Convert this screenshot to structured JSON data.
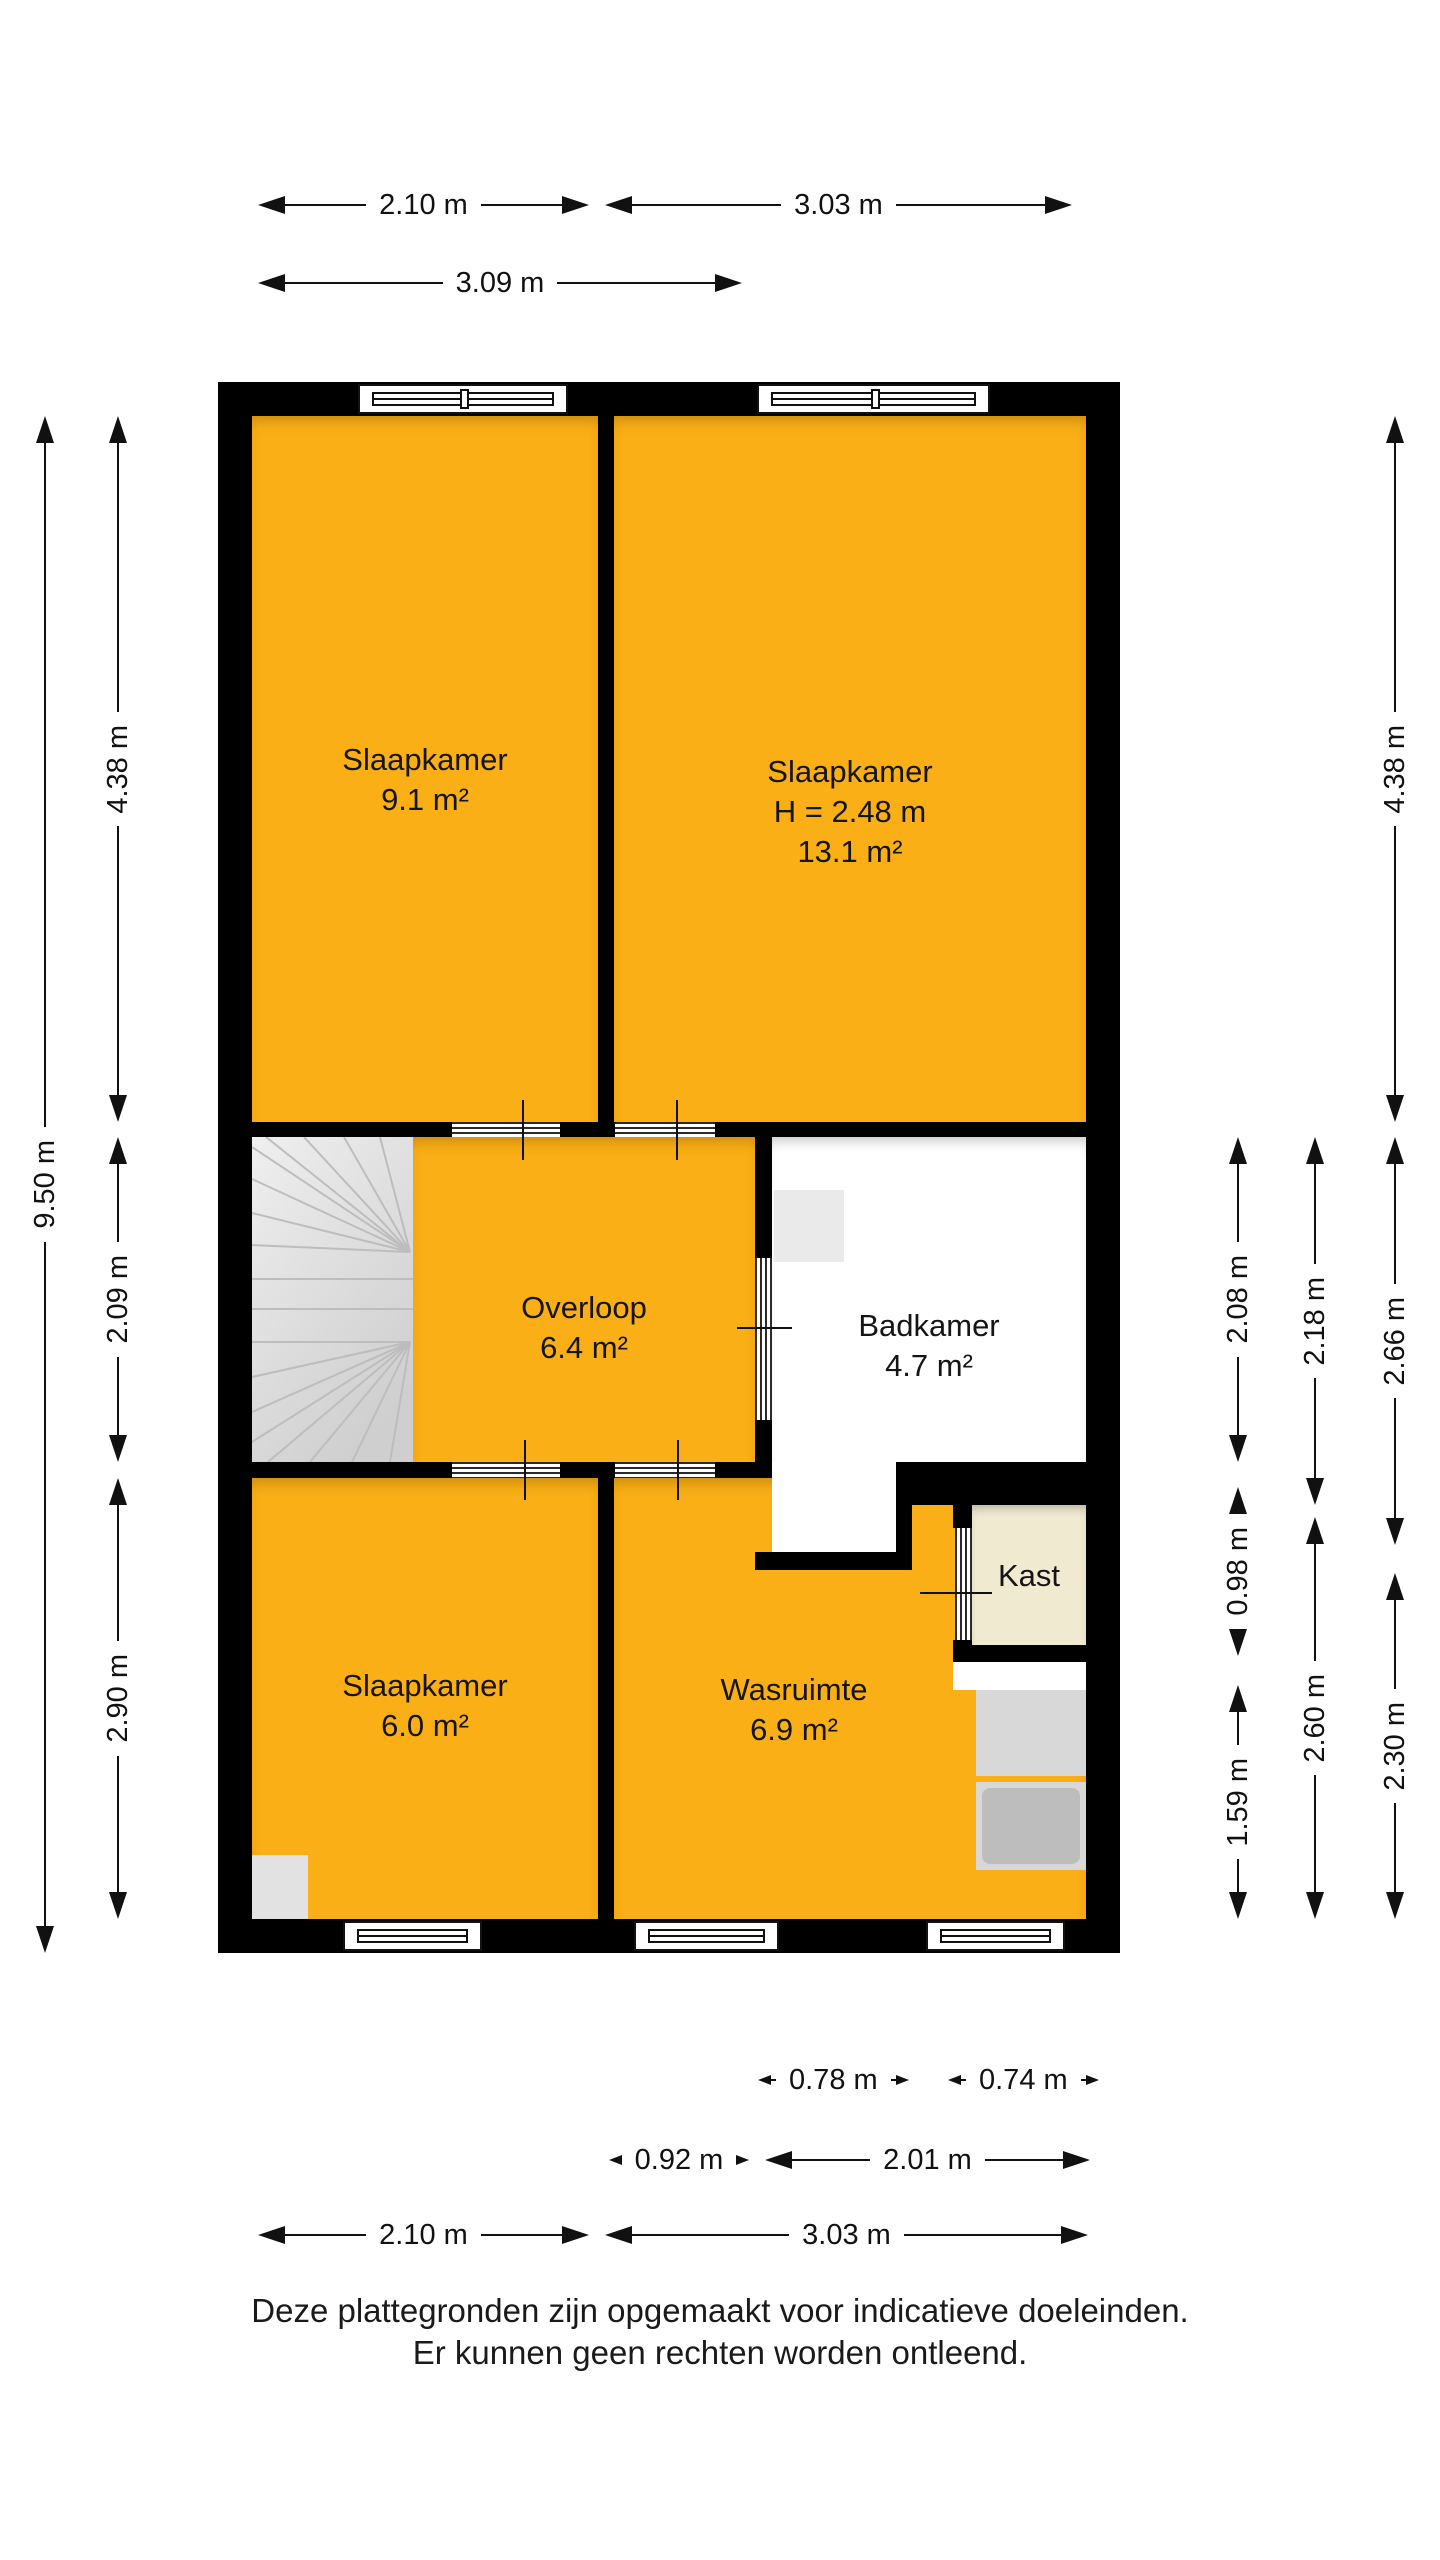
{
  "rooms": {
    "bed1": {
      "name": "Slaapkamer",
      "area": "9.1 m²"
    },
    "bed2": {
      "name": "Slaapkamer",
      "height": "H = 2.48 m",
      "area": "13.1 m²"
    },
    "hall": {
      "name": "Overloop",
      "area": "6.4 m²"
    },
    "bath": {
      "name": "Badkamer",
      "area": "4.7 m²"
    },
    "closet": {
      "name": "Kast"
    },
    "bed3": {
      "name": "Slaapkamer",
      "area": "6.0 m²"
    },
    "laundry": {
      "name": "Wasruimte",
      "area": "6.9 m²"
    }
  },
  "dims": {
    "top1": "2.10 m",
    "top2": "3.03 m",
    "top3": "3.09 m",
    "left_outer": "9.50 m",
    "left1": "4.38 m",
    "left2": "2.09 m",
    "left3": "2.90 m",
    "right_outer1": "4.38 m",
    "right_outer2": "2.66 m",
    "right_outer3": "2.30 m",
    "right_mid1": "2.18 m",
    "right_mid2": "2.60 m",
    "right_in1": "2.08 m",
    "right_in2": "0.98 m",
    "right_in3": "1.59 m",
    "bot_small1": "0.78 m",
    "bot_small2": "0.74 m",
    "bot_mid1": "0.92 m",
    "bot_mid2": "2.01 m",
    "bot1": "2.10 m",
    "bot2": "3.03 m"
  },
  "disclaimer": {
    "line1": "Deze plattegronden zijn opgemaakt voor indicatieve doeleinden.",
    "line2": "Er kunnen geen rechten worden ontleend."
  },
  "colors": {
    "room_fill": "#F9AF15",
    "wall": "#000000",
    "closet_fill": "#F0EAD0",
    "stairs_fill": "#DCDCDC",
    "appliance_fill": "#BDBDBD"
  }
}
